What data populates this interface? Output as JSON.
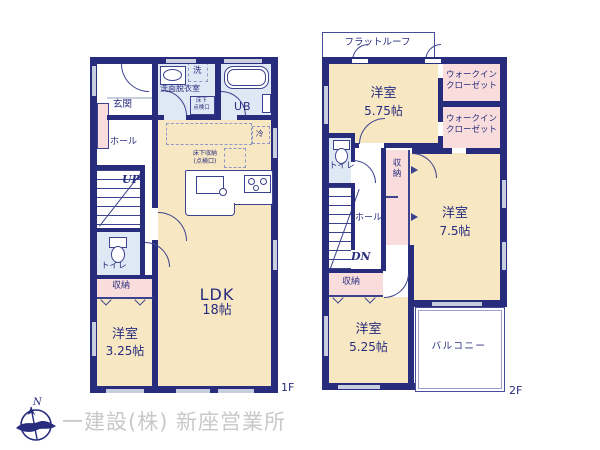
{
  "floor1": {
    "label": "1F",
    "entrance": "玄関",
    "hall": "ホール",
    "stairs": "UP",
    "toilet": "トイレ",
    "storage": "収納",
    "bedroom": {
      "name": "洋室",
      "size": "3.25帖"
    },
    "washroom": "洗面脱衣室",
    "washer": "洗",
    "underfloor_hatch": "床下\n点検口",
    "bath": "UB",
    "fridge": "冷",
    "underfloor_storage": "床下収納\n(点検口)",
    "ldk": {
      "name": "LDK",
      "size": "18帖"
    }
  },
  "floor2": {
    "label": "2F",
    "flat_roof": "フラットルーフ",
    "bedroom_575": {
      "name": "洋室",
      "size": "5.75帖"
    },
    "wic_top": "ウォークイン\nクローゼット",
    "wic_bottom": "ウォークイン\nクローゼット",
    "toilet": "トイレ",
    "closet": "収納",
    "hall": "ホール",
    "stairs": "DN",
    "bedroom_75": {
      "name": "洋室",
      "size": "7.5帖"
    },
    "storage": "収納",
    "bedroom_525": {
      "name": "洋室",
      "size": "5.25帖"
    },
    "balcony": "バルコニー"
  },
  "colors": {
    "wall": "#272c7d",
    "tatami_room": "#f7e7c2",
    "wet_room": "#dfe9f5",
    "closet": "#f9dddd"
  },
  "footer": {
    "compass_north": "N",
    "company": "一建設(株) 新座営業所"
  }
}
